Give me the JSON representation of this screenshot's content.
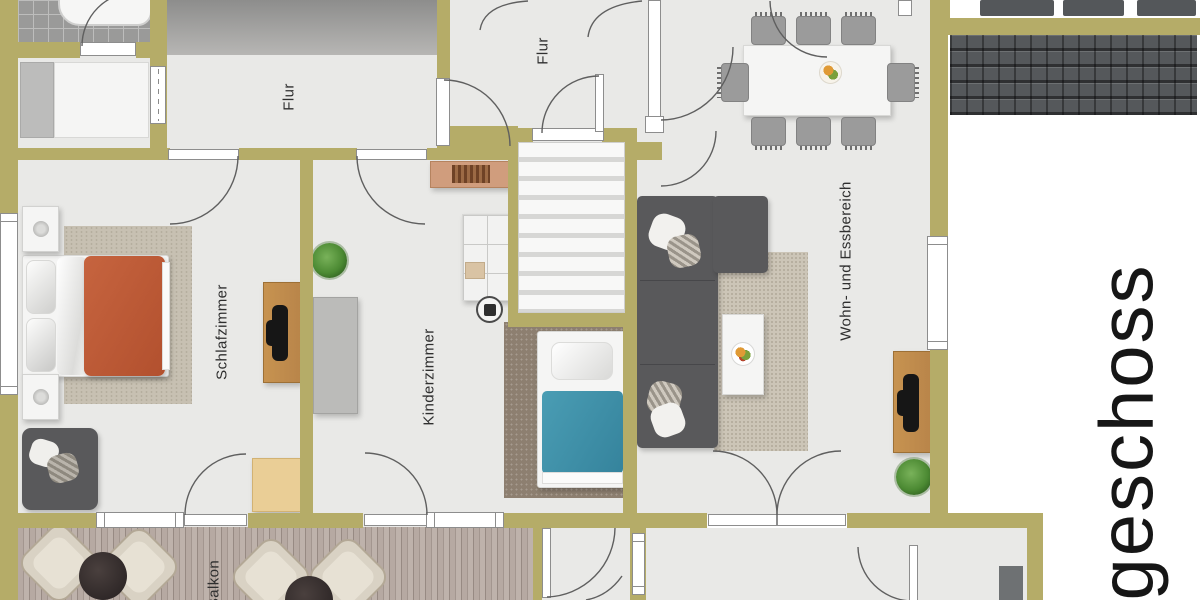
{
  "floor_plan": {
    "floor_title": "geschoss",
    "rooms": [
      {
        "id": "flur-left",
        "label": "Flur"
      },
      {
        "id": "flur-center",
        "label": "Flur"
      },
      {
        "id": "schlafzimmer",
        "label": "Schlafzimmer"
      },
      {
        "id": "kinderzimmer",
        "label": "Kinderzimmer"
      },
      {
        "id": "wohn-essbereich",
        "label": "Wohn- und Essbereich"
      },
      {
        "id": "balkon",
        "label": "Balkon"
      }
    ],
    "colors": {
      "wall": "#b5ac68",
      "floor": "#e9e9e7",
      "void_area": "#a0a09f",
      "double_bed_blanket": "#bf5b38",
      "kids_bed_blanket": "#4093ab",
      "sofa": "#59595b",
      "balcony_deck": "#b3a69f",
      "roof_tiles": "#55585b",
      "label_text": "#2f2f2f"
    }
  }
}
